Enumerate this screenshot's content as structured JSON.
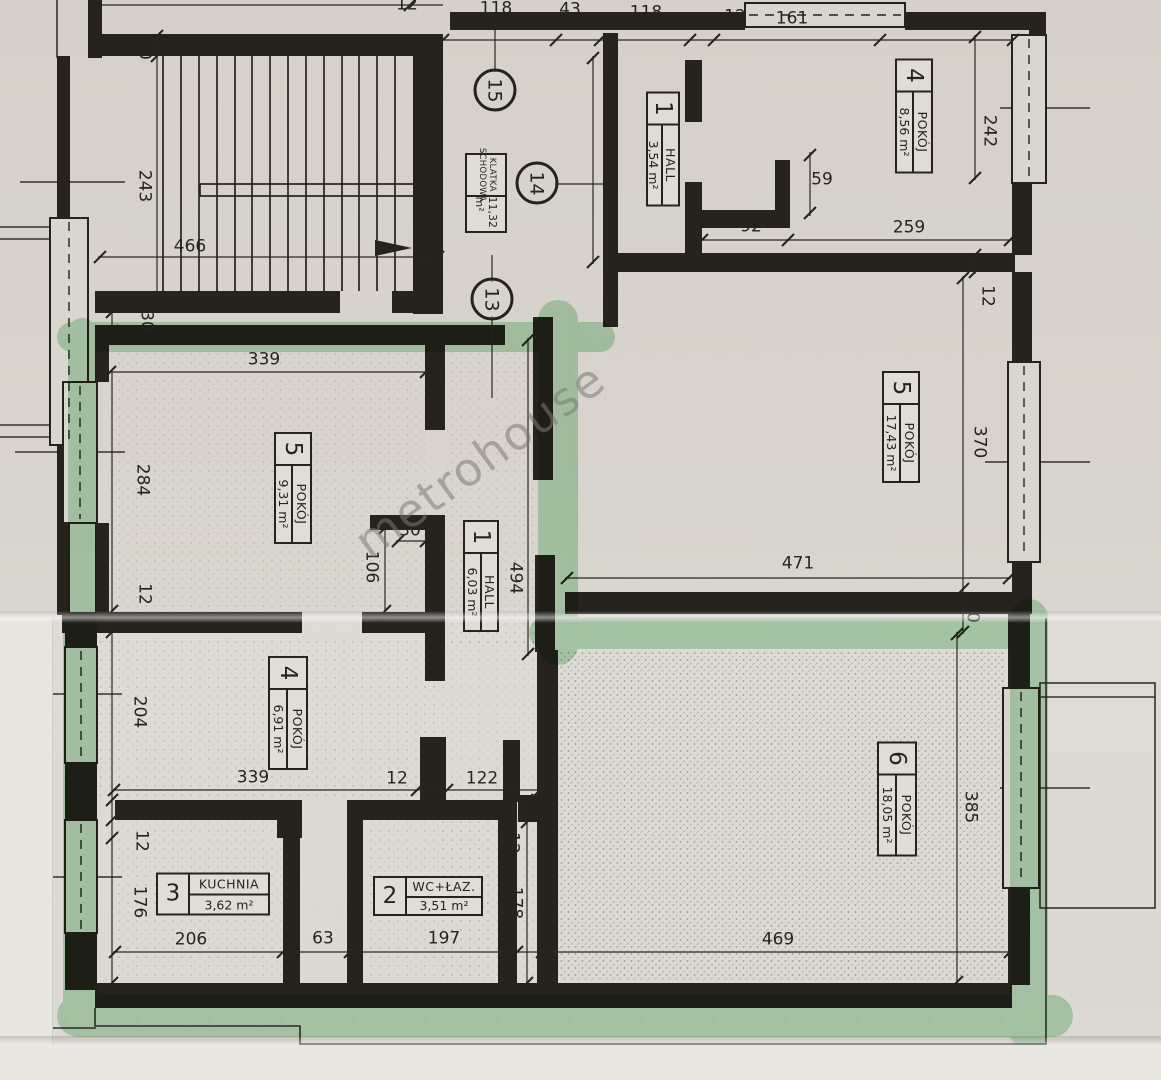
{
  "watermark": {
    "text": "metrohouse"
  },
  "colors": {
    "highlighter": "#62bb72",
    "ink": "#26231d",
    "paper": "#d8d4cd"
  },
  "unit_circles": [
    "15",
    "14",
    "13"
  ],
  "klatka": {
    "name1": "KLATKA",
    "name2": "SCHODOWA",
    "area": "11,32 m²"
  },
  "rooms": [
    {
      "num": "1",
      "name": "HALL",
      "area": "3,54 m²"
    },
    {
      "num": "4",
      "name": "POKÓJ",
      "area": "8,56 m²"
    },
    {
      "num": "5",
      "name": "POKÓJ",
      "area": "17,43 m²"
    },
    {
      "num": "5",
      "name": "POKÓJ",
      "area": "9,31 m²"
    },
    {
      "num": "1",
      "name": "HALL",
      "area": "6,03 m²"
    },
    {
      "num": "4",
      "name": "POKÓJ",
      "area": "6,91 m²"
    },
    {
      "num": "3",
      "name": "KUCHNIA",
      "area": "3,62 m²"
    },
    {
      "num": "2",
      "name": "WC+ŁAZ.",
      "area": "3,51 m²"
    },
    {
      "num": "6",
      "name": "POKÓJ",
      "area": "18,05 m²"
    }
  ],
  "dims": [
    "12",
    "118",
    "43",
    "118",
    "12",
    "161",
    "30",
    "243",
    "466",
    "30",
    "300",
    "59",
    "92",
    "259",
    "242",
    "12",
    "339",
    "284",
    "12",
    "30",
    "106",
    "494",
    "471",
    "370",
    "30",
    "204",
    "339",
    "12",
    "122",
    "12",
    "176",
    "206",
    "63",
    "197",
    "12",
    "178",
    "385",
    "469"
  ]
}
